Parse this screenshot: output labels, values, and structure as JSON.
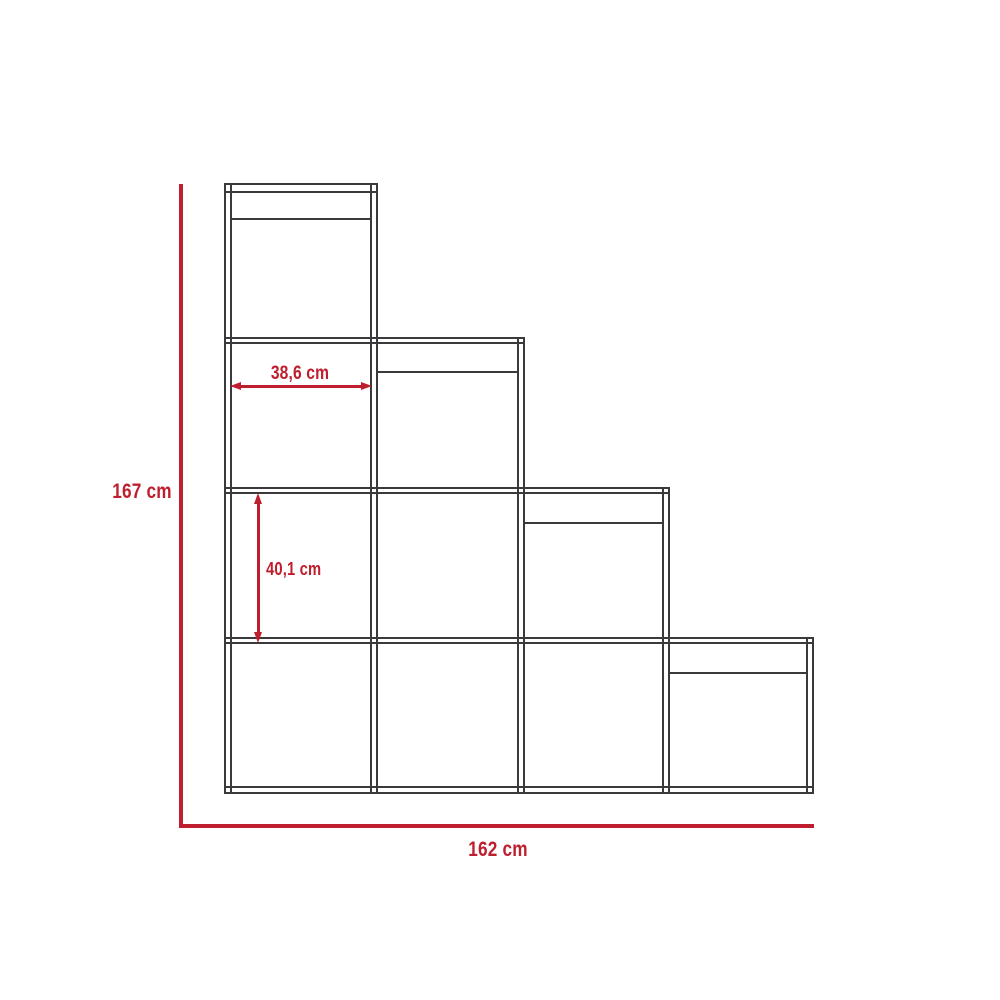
{
  "colors": {
    "background": "#ffffff",
    "outline": "#3a3a3c",
    "dimension": "#be1e2d"
  },
  "diagram": {
    "kind": "furniture dimension drawing",
    "product": "staircase cube bookcase",
    "columns": 4,
    "cubes_per_column": [
      4,
      3,
      2,
      1
    ],
    "dimensions": {
      "overall_height": "167 cm",
      "overall_width": "162 cm",
      "cube_width": "38,6 cm",
      "cube_height": "40,1 cm"
    }
  }
}
